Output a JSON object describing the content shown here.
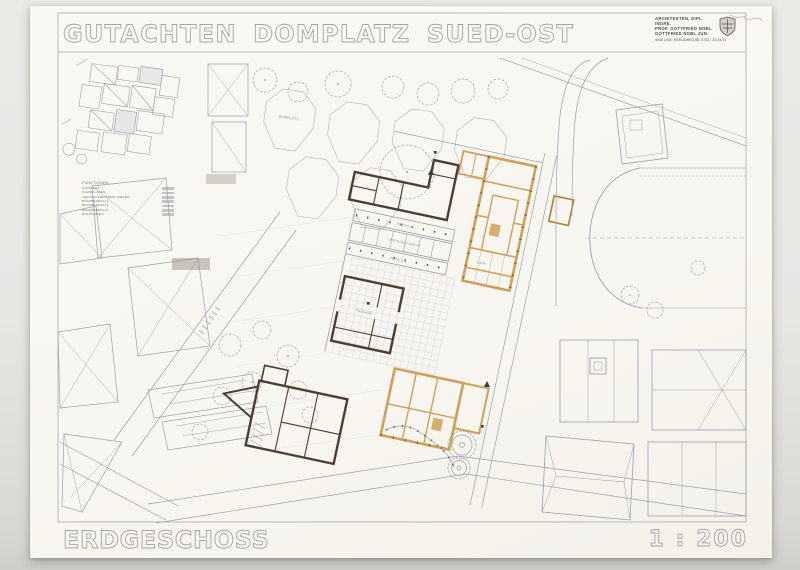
{
  "sheet": {
    "title": "GUTACHTEN DOMPLATZ SUED-OST",
    "floor_label": "ERDGESCHOSS",
    "scale_label": "1 : 200"
  },
  "stamp": {
    "line1": "ARCHITEKTEN, DIPL. INGRE.",
    "line2": "PROF. GOTTFRIED NOBL",
    "line3": "GOTTFRIED NOBL JUN.",
    "line4": "4040 LINZ, KREUZWEG 85, 0732 / 23 24 91"
  },
  "legend": {
    "title": "FUNKTIONEN",
    "items": [
      {
        "label": "CAFEHAUS"
      },
      {
        "label": "KLEINE LÄDEN"
      },
      {
        "label": "VERKAUFSZENTRUM, MIETER"
      },
      {
        "label": "BÜROBEREICH 1"
      },
      {
        "label": "BÜROBEREICH 2"
      },
      {
        "label": "BÜROBEREICH 3"
      },
      {
        "label": "WOHNUNGEN"
      }
    ]
  },
  "plan": {
    "labels": {
      "domplatz": "DOMPLATZ",
      "pergola_top": "PERGOLA",
      "laden": "LADENGESCHÄFTE",
      "pergola_bottom": "PERGOLA",
      "cafe": "CAFE",
      "passage": "PASSAGE"
    }
  },
  "colors": {
    "paper": "#f9f7f2",
    "background": "#e6e5e2",
    "linework": "#9aa0a8",
    "dark_wall": "#4d3e35",
    "orange_wall": "#cfa057",
    "stencil_outline": "#a4a4a3"
  }
}
